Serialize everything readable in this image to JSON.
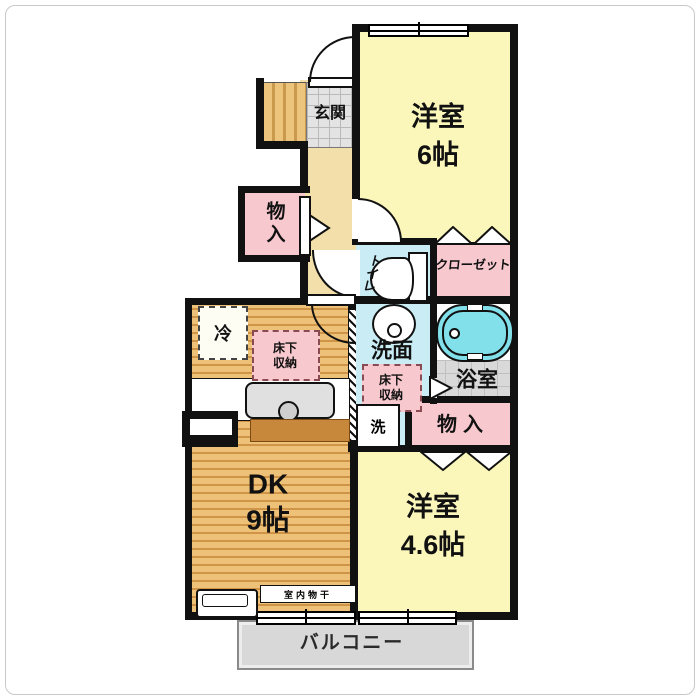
{
  "rooms": {
    "entrance": {
      "label": "玄関"
    },
    "western_room_6": {
      "label": "洋室",
      "size": "6帖"
    },
    "storage_top": {
      "label": "物入"
    },
    "toilet": {
      "label": "トイレ"
    },
    "closet": {
      "label": "クローゼット"
    },
    "washroom": {
      "label": "洗面"
    },
    "bathroom": {
      "label": "浴室"
    },
    "storage_bottom": {
      "label": "物入"
    },
    "dining_kitchen": {
      "label": "DK",
      "size": "9帖"
    },
    "western_room_46": {
      "label": "洋室",
      "size": "4.6帖"
    },
    "balcony": {
      "label": "バルコニー"
    }
  },
  "features": {
    "refrigerator": "冷",
    "underfloor_storage_dk": "床下収納",
    "underfloor_storage_wash": "床下収納",
    "washing_machine": "洗",
    "indoor_drying": "室内物干"
  },
  "colors": {
    "wall": "#111111",
    "room_yellow": "#fbf7bb",
    "storage_pink": "#f7c9cf",
    "wet_area_blue": "#c9ecf5",
    "bathtub_cyan": "#82e0ea",
    "wood_floor": "#eec178",
    "hall_cream": "#f2dfa9",
    "balcony_gray": "#d8d8d8"
  }
}
